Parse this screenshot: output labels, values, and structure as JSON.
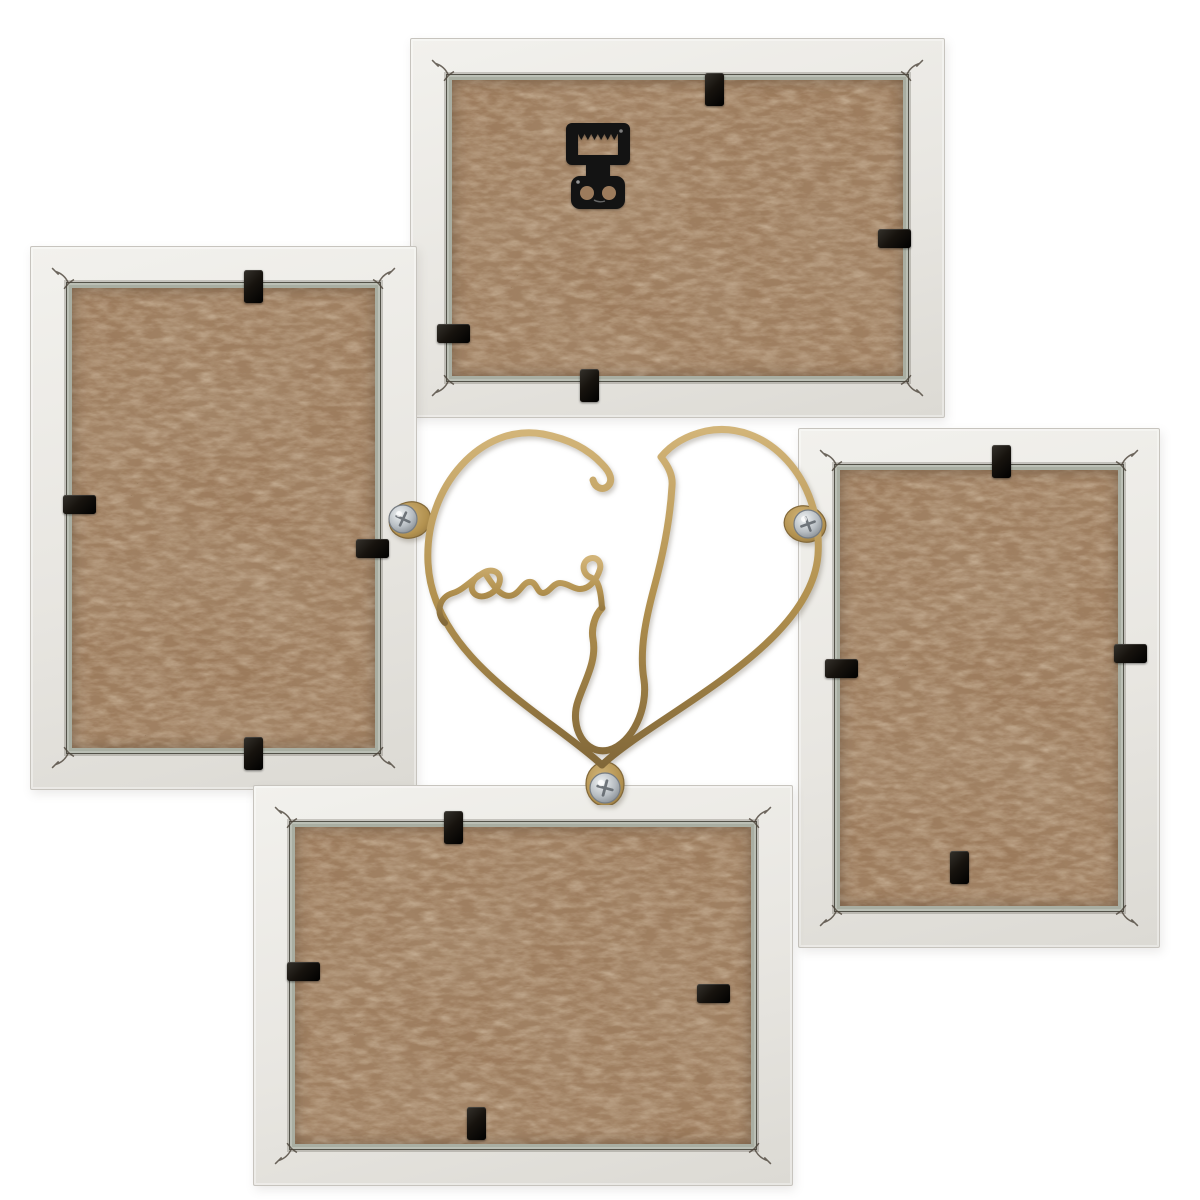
{
  "meta": {
    "domain": "Natural-Image",
    "title": "Back of a four-aperture white collage photo frame with gold wire Love heart",
    "description": "Rear view of a white wooden multi-photo collage frame: two landscape and two portrait frames with brown hardboard backs held by black metal clips, arranged around a central gold wire heart that spells the word Love (appearing mirrored from the back), attached with three screwed gold tabs; the top frame carries a black sawtooth hanging bracket."
  },
  "colors": {
    "background": "#ffffff",
    "frame": "#e8e6e1",
    "frame_hi": "#f2f1ed",
    "frame_lo": "#dcdad4",
    "frame_edge": "#c7c4be",
    "glass": "#a9aea2",
    "mdf": "#9c7b5c",
    "mdf_fiber": "#bd9f7b",
    "mdf_speck": "#352413",
    "clip": "#17130e",
    "hanger": "#131313",
    "gold": "#b2914f",
    "gold_hi": "#d2b478",
    "gold_dark": "#826839",
    "screw_hi": "#f0f3f4",
    "screw": "#b7bdc2",
    "screw_dark": "#767c82",
    "vnail": "#4c443a"
  },
  "scene": {
    "label": "Back of a four-photo white collage frame joined by a gold wire love-heart ornament",
    "frames": [
      {
        "id": "top",
        "label": "Top landscape frame, back side with sawtooth hanger",
        "orientation": "landscape",
        "backing": "hardboard",
        "clip_count": 4,
        "has_sawtooth_hanger": true
      },
      {
        "id": "left",
        "label": "Left portrait frame, back side",
        "orientation": "portrait",
        "backing": "hardboard",
        "clip_count": 4,
        "has_sawtooth_hanger": false
      },
      {
        "id": "right",
        "label": "Right portrait frame, back side",
        "orientation": "portrait",
        "backing": "hardboard",
        "clip_count": 4,
        "has_sawtooth_hanger": false
      },
      {
        "id": "bottom",
        "label": "Bottom landscape frame, back side",
        "orientation": "landscape",
        "backing": "hardboard",
        "clip_count": 4,
        "has_sawtooth_hanger": false
      }
    ],
    "hanger_label": "Black sawtooth hanging bracket",
    "clip_label": "Black metal backing clip",
    "vnail_label": "V-nail corner joint mark",
    "heart": {
      "label": "Gold wire heart ornament spelling Love, seen mirrored from the back",
      "word": "Love",
      "appears_mirrored": true,
      "tab_count": 3,
      "screw_count": 3,
      "tab_label": "Gold mounting tab",
      "screw_label": "Silver Phillips pan-head screw"
    }
  }
}
